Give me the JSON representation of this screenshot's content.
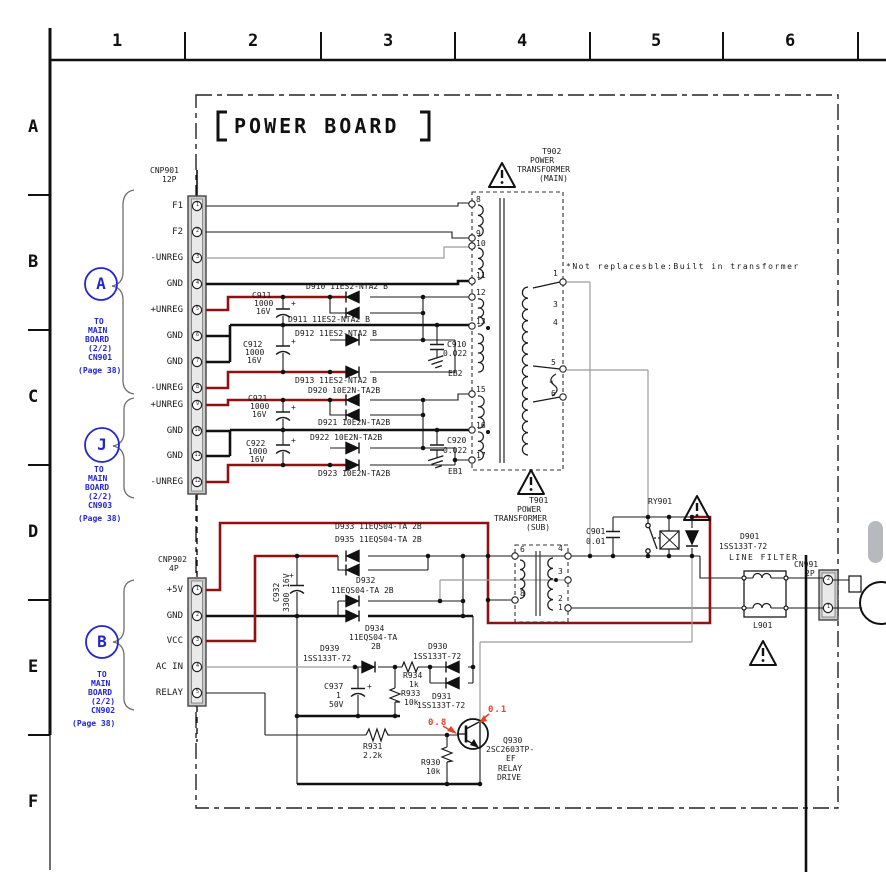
{
  "meta": {
    "title": "POWER BOARD",
    "note": "*Not replacesble:Built in transformer"
  },
  "grid": {
    "cols": [
      "1",
      "2",
      "3",
      "4",
      "5",
      "6"
    ],
    "rows": [
      "A",
      "B",
      "C",
      "D",
      "E",
      "F"
    ]
  },
  "conn": {
    "cnp901": {
      "ref": "CNP901",
      "size": "12P",
      "pins": [
        "F1",
        "F2",
        "-UNREG",
        "GND",
        "+UNREG",
        "GND",
        "GND",
        "-UNREG",
        "+UNREG",
        "GND",
        "GND",
        "-UNREG"
      ],
      "nums": [
        "1",
        "2",
        "3",
        "4",
        "5",
        "6",
        "7",
        "8",
        "9",
        "10",
        "11",
        "12"
      ]
    },
    "cnp902": {
      "ref": "CNP902",
      "size": "4P",
      "pins": [
        "+5V",
        "GND",
        "VCC",
        "AC IN",
        "RELAY"
      ],
      "nums": [
        "1",
        "2",
        "3",
        "4",
        "5"
      ]
    },
    "cn991": {
      "ref": "CN991",
      "size": "2P",
      "nums": [
        "2",
        "1"
      ]
    }
  },
  "links": {
    "a": {
      "id": "A",
      "l1": "TO",
      "l2": "MAIN",
      "l3": "BOARD",
      "l4": "(2/2)",
      "l5": "CN901",
      "l6": "(Page 38)"
    },
    "j": {
      "id": "J",
      "l1": "TO",
      "l2": "MAIN",
      "l3": "BOARD",
      "l4": "(2/2)",
      "l5": "CN903",
      "l6": "(Page 38)"
    },
    "b": {
      "id": "B",
      "l1": "TO",
      "l2": "MAIN",
      "l3": "BOARD",
      "l4": "(2/2)",
      "l5": "CN902",
      "l6": "(Page 38)"
    }
  },
  "t902": {
    "ref": "T902",
    "l1": "POWER",
    "l2": "TRANSFORMER",
    "l3": "(MAIN)",
    "lp": [
      "8",
      "9",
      "10",
      "11",
      "12",
      "13",
      "15",
      "16",
      "17"
    ],
    "rp": [
      "1",
      "3",
      "4",
      "5",
      "*",
      "6"
    ]
  },
  "t901": {
    "ref": "T901",
    "l1": "POWER",
    "l2": "TRANSFORMER",
    "l3": "(SUB)",
    "lp": [
      "6",
      "8"
    ],
    "rp": [
      "4",
      "3",
      "2",
      "1"
    ]
  },
  "c": {
    "d910": "D910 11ES2-NTA2 B",
    "d911": "D911 11ES2-NTA2 B",
    "d912": "D912 11ES2-NTA2 B",
    "d913": "D913 11ES2-NTA2 B",
    "d920": "D920 10E2N-TA2B",
    "d921": "D921 10E2N-TA2B",
    "d922": "D922 10E2N-TA2B",
    "d923": "D923 10E2N-TA2B",
    "d933": "D933 11EQS04-TA 2B",
    "d935": "D935 11EQS04-TA 2B",
    "d932": {
      "r": "D932",
      "v": "11EQS04-TA 2B"
    },
    "d934": {
      "r": "D934",
      "v": "11EQS04-TA",
      "u": "2B"
    },
    "d939": {
      "r": "D939",
      "v": "1SS133T-72"
    },
    "d930": {
      "r": "D930",
      "v": "1SS133T-72"
    },
    "d931": {
      "r": "D931",
      "v": "1SS133T-72"
    },
    "d901": {
      "r": "D901",
      "v": "1SS133T-72"
    },
    "c911": {
      "r": "C911",
      "v": "1000",
      "u": "16V"
    },
    "c912": {
      "r": "C912",
      "v": "1000",
      "u": "16V"
    },
    "c921": {
      "r": "C921",
      "v": "1000",
      "u": "16V"
    },
    "c922": {
      "r": "C922",
      "v": "1000",
      "u": "16V"
    },
    "c910": {
      "r": "C910",
      "v": "0.022"
    },
    "c920": {
      "r": "C920",
      "v": "0.022"
    },
    "c901": {
      "r": "C901",
      "v": "0.01"
    },
    "c932": {
      "r": "C932",
      "v": "3300 16V"
    },
    "c937": {
      "r": "C937",
      "v": "1",
      "u": "50V"
    },
    "r934": {
      "r": "R934",
      "v": "1k"
    },
    "r933": {
      "r": "R933",
      "v": "10k"
    },
    "r931": {
      "r": "R931",
      "v": "2.2k"
    },
    "r930": {
      "r": "R930",
      "v": "10k"
    },
    "q930": {
      "r": "Q930",
      "p1": "2SC2603TP-",
      "p2": "EF",
      "f1": "RELAY",
      "f2": "DRIVE"
    },
    "ry901": "RY901",
    "l901": "L901",
    "lf": "LINE FILTER",
    "eb1": "EB1",
    "eb2": "EB2",
    "plus": "+"
  },
  "meas": {
    "base": "0.8",
    "collector": "0.1"
  },
  "colors": {
    "wire_red": "#8f1111",
    "meas_red": "#e2442b",
    "link_blue": "#2326cd",
    "wire_gray": "#9c9c9c"
  }
}
